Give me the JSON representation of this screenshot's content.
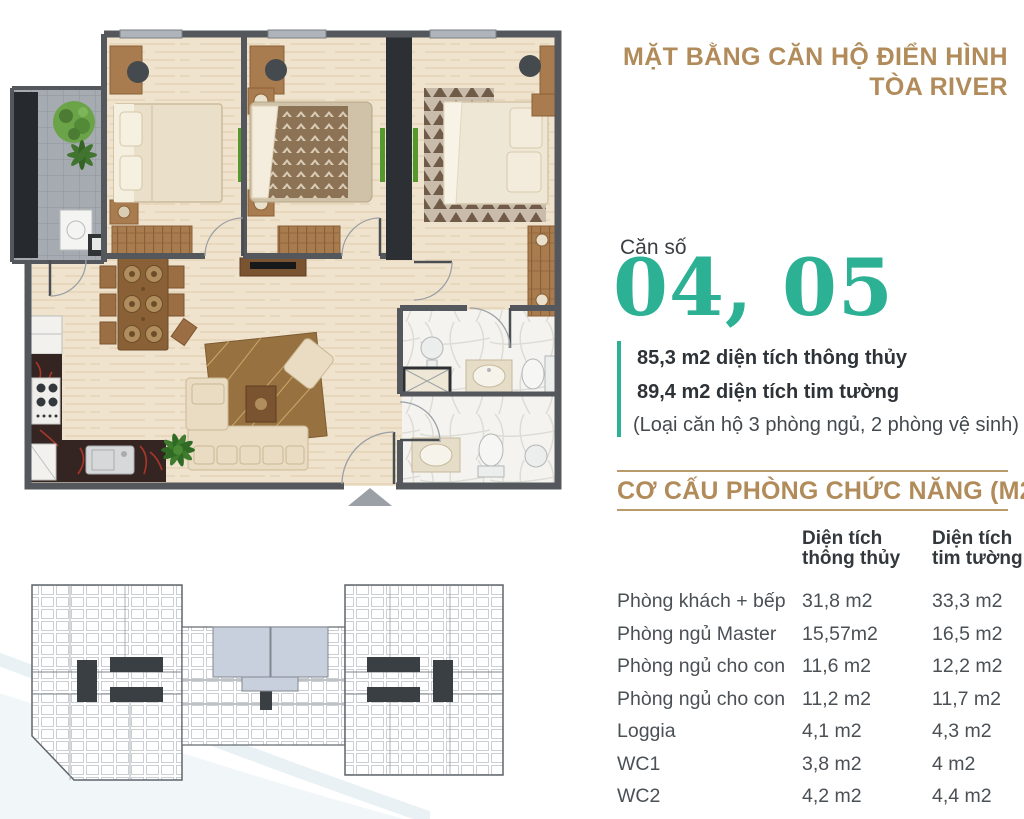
{
  "header": {
    "title_line1": "MẶT BẰNG CĂN HỘ ĐIỂN HÌNH",
    "title_line2": "TÒA RIVER"
  },
  "unit": {
    "label": "Căn số",
    "numbers": "04, 05",
    "area_line1": "85,3 m2 diện tích thông thủy",
    "area_line2": "89,4 m2 diện tích tim tường",
    "type_note": "(Loại căn hộ 3 phòng ngủ, 2 phòng vệ sinh)"
  },
  "section": {
    "title": "CƠ CẤU PHÒNG CHỨC NĂNG (M2)"
  },
  "table": {
    "col_net": {
      "line1": "Diện tích",
      "line2": "thông thủy"
    },
    "col_gross": {
      "line1": "Diện tích",
      "line2": "tim tường"
    },
    "rows": [
      {
        "name": "Phòng khách + bếp",
        "net": "31,8 m2",
        "gross": "33,3 m2"
      },
      {
        "name": "Phòng ngủ Master",
        "net": "15,57m2",
        "gross": "16,5 m2"
      },
      {
        "name": "Phòng ngủ cho con",
        "net": "11,6 m2",
        "gross": "12,2 m2"
      },
      {
        "name": "Phòng ngủ cho con",
        "net": "11,2 m2",
        "gross": "11,7 m2"
      },
      {
        "name": "Loggia",
        "net": "4,1 m2",
        "gross": "4,3 m2"
      },
      {
        "name": "WC1",
        "net": "3,8 m2",
        "gross": "4 m2"
      },
      {
        "name": "WC2",
        "net": "4,2 m2",
        "gross": "4,4 m2"
      }
    ]
  },
  "colors": {
    "gold": "#b18c5a",
    "teal": "#2cb194",
    "highlight_unit": "#c9d0dd"
  }
}
